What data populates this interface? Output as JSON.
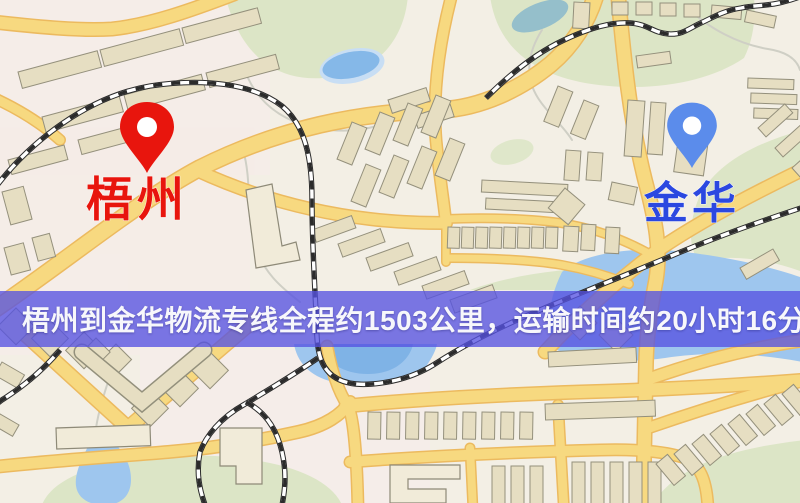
{
  "map": {
    "markers": {
      "origin": {
        "label": "梧州",
        "pin_color": "#E8150D",
        "label_color": "#E8150D"
      },
      "destination": {
        "label": "金华",
        "pin_color": "#5B8CEB",
        "label_color": "#2B48E0"
      }
    },
    "palette": {
      "background": "#F3EFE5",
      "road": "#F7D980",
      "road_casing": "#ECBA5F",
      "water": "#9EC6EE",
      "park": "#DCE5C6",
      "building": "#E6DEC2",
      "railway": "#2B2B2B"
    }
  },
  "banner": {
    "text": "梧州到金华物流专线全程约1503公里，运输时间约20小时16分钟.",
    "background_color": "#5652E1",
    "text_color": "#F7F7FB"
  },
  "route": {
    "origin": "梧州",
    "destination": "金华",
    "distance_km": "1503",
    "duration": "20小时16分钟"
  }
}
